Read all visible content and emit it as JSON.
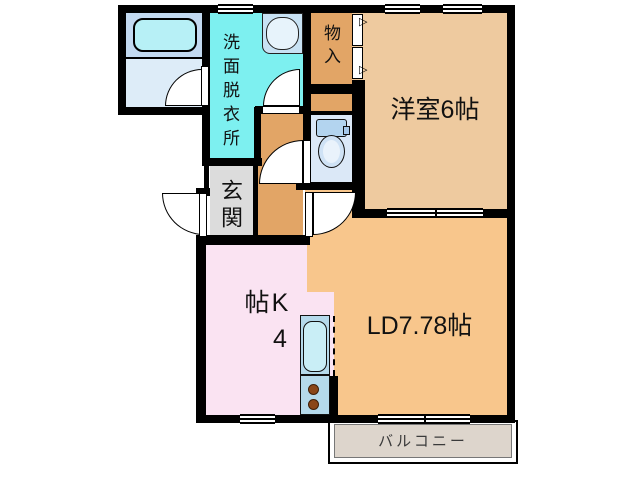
{
  "plan": {
    "washroom_label": "洗面脱衣所",
    "closet_label": "物入",
    "western_room_label": "洋室6帖",
    "entrance_label": "玄関",
    "kitchen_label": "K4帖",
    "living_dining_label": "LD7.78帖",
    "balcony_label": "バルコニー"
  },
  "colors": {
    "wall": "#000000",
    "washroom": "#7df0f0",
    "bathroom_upper": "#c3daf1",
    "bathroom_lower": "#ddecf8",
    "bathtub": "#b7f0f6",
    "closet_hall": "#e2a566",
    "western_room": "#eeca9f",
    "living_dining": "#f8c68c",
    "kitchen": "#fae3f2",
    "entrance": "#dcdcdc",
    "toilet_room": "#dbe8f7",
    "balcony": "#ddd5cc",
    "counter": "#b5daeb",
    "sink": "#c9eef6",
    "burner": "#8a4618"
  }
}
